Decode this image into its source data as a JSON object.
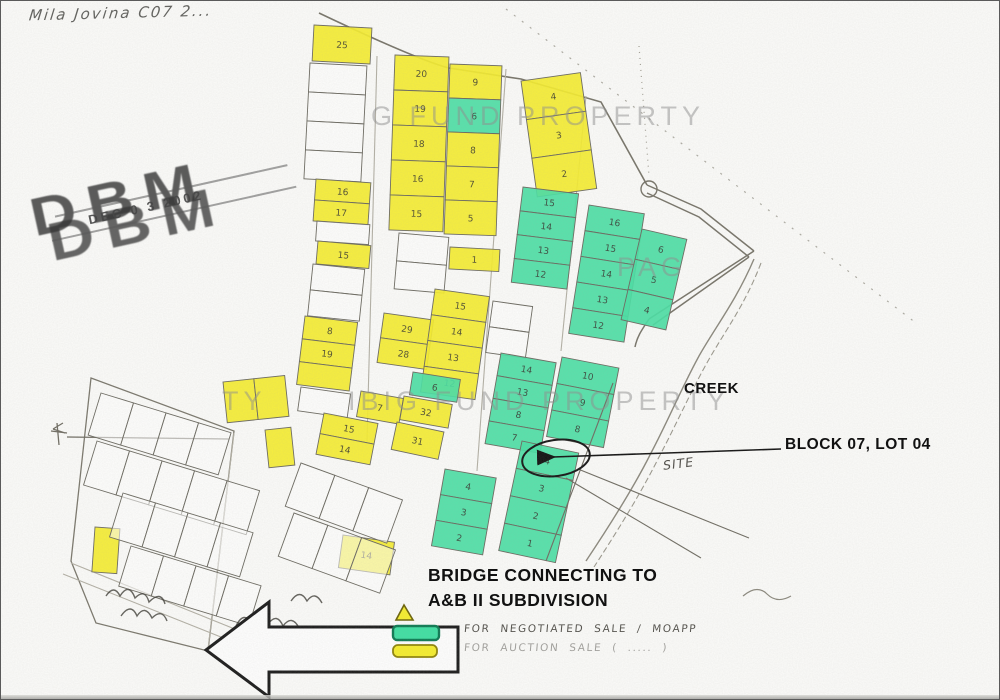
{
  "canvas": {
    "width": 1000,
    "height": 700
  },
  "colors": {
    "paper": "#fcfcfa",
    "lot_yellow": "#f6ee2d",
    "lot_yellow_border": "#8f8408",
    "lot_green": "#49e0a4",
    "lot_green_border": "#0d8a5f",
    "pencil": "#6b6960",
    "ink": "#1c1c1c",
    "watermark": "#8f8f8f"
  },
  "annotations": {
    "handwritten_title": "Mila Jovina  C07 2...",
    "creek": "CREEK",
    "block_lot": "BLOCK 07, LOT 04",
    "site": "SITE",
    "bridge_line1": "BRIDGE CONNECTING TO",
    "bridge_line2": "A&B II SUBDIVISION"
  },
  "stamp": {
    "agency": "DBM",
    "date": "DEC 0 3 2002"
  },
  "watermark_fragments": [
    {
      "text": "G FUND PROPERTY",
      "x": 370,
      "y": 100
    },
    {
      "text": "PAG",
      "x": 616,
      "y": 251
    },
    {
      "text": "TY",
      "x": 221,
      "y": 385
    },
    {
      "text": "IBIG FUND PROPERTY",
      "x": 347,
      "y": 385
    }
  ],
  "legend": {
    "items": [
      {
        "label": "FOR NEGOTIATED SALE / MOAPP",
        "color": "#3fe0a3",
        "border": "#0c7a52"
      },
      {
        "label": "FOR AUCTION SALE ( ..... )",
        "color": "#f6ee2d",
        "border": "#8f8408"
      }
    ]
  },
  "map": {
    "circled_lot": "4",
    "groups": [
      {
        "id": "lot25",
        "x": 313,
        "y": 24,
        "w": 58,
        "h": 36,
        "rot": 3,
        "cells": [
          {
            "c": "y",
            "n": "25"
          }
        ]
      },
      {
        "id": "leftcol-a",
        "x": 309,
        "y": 62,
        "w": 57,
        "h": 29,
        "rot": 3,
        "cells": [
          {
            "c": "w",
            "n": ""
          },
          {
            "c": "w",
            "n": ""
          },
          {
            "c": "w",
            "n": ""
          },
          {
            "c": "w",
            "n": ""
          }
        ]
      },
      {
        "id": "leftcol-b",
        "x": 315,
        "y": 178,
        "w": 55,
        "h": 21,
        "rot": 4,
        "cells": [
          {
            "c": "y",
            "n": "16"
          },
          {
            "c": "y",
            "n": "17"
          }
        ]
      },
      {
        "id": "leftcol-c",
        "x": 316,
        "y": 220,
        "w": 53,
        "h": 20,
        "rot": 4,
        "cells": [
          {
            "c": "w",
            "n": ""
          }
        ]
      },
      {
        "id": "leftcol-d",
        "x": 317,
        "y": 240,
        "w": 53,
        "h": 23,
        "rot": 5,
        "cells": [
          {
            "c": "y",
            "n": "15"
          }
        ]
      },
      {
        "id": "leftcol-e",
        "x": 312,
        "y": 263,
        "w": 52,
        "h": 26,
        "rot": 6,
        "cells": [
          {
            "c": "w",
            "n": ""
          },
          {
            "c": "w",
            "n": ""
          }
        ]
      },
      {
        "id": "leftcol-f",
        "x": 304,
        "y": 315,
        "w": 53,
        "h": 23,
        "rot": 7,
        "cells": [
          {
            "c": "y",
            "n": "8"
          },
          {
            "c": "y",
            "n": "19"
          },
          {
            "c": "y",
            "n": ""
          }
        ]
      },
      {
        "id": "leftcol-g",
        "x": 300,
        "y": 386,
        "w": 50,
        "h": 24,
        "rot": 8,
        "cells": [
          {
            "c": "w",
            "n": ""
          }
        ]
      },
      {
        "id": "leftcol-h",
        "x": 323,
        "y": 412,
        "w": 55,
        "h": 21,
        "rot": 11,
        "cells": [
          {
            "c": "y",
            "n": "15"
          },
          {
            "c": "y",
            "n": "14"
          }
        ]
      },
      {
        "id": "col2",
        "x": 394,
        "y": 54,
        "w": 54,
        "h": 35,
        "rot": 2,
        "cells": [
          {
            "c": "y",
            "n": "20"
          },
          {
            "c": "y",
            "n": "19"
          },
          {
            "c": "y",
            "n": "18"
          },
          {
            "c": "y",
            "n": "16"
          },
          {
            "c": "y",
            "n": "15"
          }
        ]
      },
      {
        "id": "col3",
        "x": 449,
        "y": 63,
        "w": 52,
        "h": 34,
        "rot": 2,
        "cells": [
          {
            "c": "y",
            "n": "9"
          },
          {
            "c": "g",
            "n": "6"
          },
          {
            "c": "y",
            "n": "8"
          },
          {
            "c": "y",
            "n": "7"
          },
          {
            "c": "y",
            "n": "5"
          }
        ]
      },
      {
        "id": "col4",
        "x": 520,
        "y": 80,
        "w": 60,
        "h": 39,
        "rot": -8,
        "cells": [
          {
            "c": "y",
            "n": "4"
          },
          {
            "c": "y",
            "n": "3"
          },
          {
            "c": "y",
            "n": "2"
          }
        ]
      },
      {
        "id": "uc-white",
        "x": 398,
        "y": 232,
        "w": 50,
        "h": 28,
        "rot": 5,
        "cells": [
          {
            "c": "w",
            "n": ""
          },
          {
            "c": "w",
            "n": ""
          }
        ]
      },
      {
        "id": "mid-1",
        "x": 449,
        "y": 246,
        "w": 50,
        "h": 22,
        "rot": 3,
        "cells": [
          {
            "c": "y",
            "n": "1"
          }
        ]
      },
      {
        "id": "mc-white",
        "x": 492,
        "y": 300,
        "w": 40,
        "h": 26,
        "rot": 8,
        "cells": [
          {
            "c": "w",
            "n": ""
          },
          {
            "c": "w",
            "n": ""
          }
        ]
      },
      {
        "id": "mid-29",
        "x": 383,
        "y": 312,
        "w": 50,
        "h": 25,
        "rot": 8,
        "cells": [
          {
            "c": "y",
            "n": "29"
          },
          {
            "c": "y",
            "n": "28"
          }
        ]
      },
      {
        "id": "mid-tall",
        "x": 434,
        "y": 288,
        "w": 55,
        "h": 26,
        "rot": 8,
        "cells": [
          {
            "c": "y",
            "n": "15"
          },
          {
            "c": "y",
            "n": "14"
          },
          {
            "c": "y",
            "n": "13"
          },
          {
            "c": "y",
            "n": "12"
          }
        ]
      },
      {
        "id": "mid-g6",
        "x": 412,
        "y": 371,
        "w": 48,
        "h": 23,
        "rot": 9,
        "cells": [
          {
            "c": "g",
            "n": "6"
          }
        ]
      },
      {
        "id": "mid-7",
        "x": 360,
        "y": 390,
        "w": 43,
        "h": 26,
        "rot": 10,
        "cells": [
          {
            "c": "y",
            "n": "7"
          }
        ]
      },
      {
        "id": "mid-32",
        "x": 403,
        "y": 395,
        "w": 49,
        "h": 24,
        "rot": 10,
        "cells": [
          {
            "c": "y",
            "n": "32"
          }
        ]
      },
      {
        "id": "mid-31",
        "x": 396,
        "y": 421,
        "w": 48,
        "h": 28,
        "rot": 12,
        "cells": [
          {
            "c": "y",
            "n": "31"
          }
        ]
      },
      {
        "id": "pair-top",
        "x": 222,
        "y": 381,
        "w": 31,
        "h": 41,
        "rot": -6,
        "dir": "h",
        "cells": [
          {
            "c": "y",
            "n": ""
          },
          {
            "c": "y",
            "n": ""
          }
        ]
      },
      {
        "id": "single-right",
        "x": 264,
        "y": 429,
        "w": 26,
        "h": 38,
        "rot": -6,
        "cells": [
          {
            "c": "y",
            "n": ""
          }
        ]
      },
      {
        "id": "narrow-left",
        "x": 94,
        "y": 526,
        "w": 25,
        "h": 45,
        "rot": 4,
        "cells": [
          {
            "c": "y",
            "n": ""
          }
        ]
      },
      {
        "id": "bottom-mid",
        "x": 342,
        "y": 534,
        "w": 52,
        "h": 33,
        "rot": 8,
        "cells": [
          {
            "c": "y",
            "n": "14"
          }
        ]
      },
      {
        "id": "g-col1",
        "x": 522,
        "y": 186,
        "w": 56,
        "h": 24,
        "rot": 7,
        "cells": [
          {
            "c": "g",
            "n": "15"
          },
          {
            "c": "g",
            "n": "14"
          },
          {
            "c": "g",
            "n": "13"
          },
          {
            "c": "g",
            "n": "12"
          }
        ]
      },
      {
        "id": "g-col2",
        "x": 588,
        "y": 204,
        "w": 56,
        "h": 26,
        "rot": 9,
        "cells": [
          {
            "c": "g",
            "n": "16"
          },
          {
            "c": "g",
            "n": "15"
          },
          {
            "c": "g",
            "n": "14"
          },
          {
            "c": "g",
            "n": "13"
          },
          {
            "c": "g",
            "n": "12"
          }
        ]
      },
      {
        "id": "g-col2b",
        "x": 641,
        "y": 228,
        "w": 46,
        "h": 31,
        "rot": 13,
        "cells": [
          {
            "c": "g",
            "n": "6"
          },
          {
            "c": "g",
            "n": "5"
          },
          {
            "c": "g",
            "n": "4"
          }
        ]
      },
      {
        "id": "g-col3",
        "x": 500,
        "y": 352,
        "w": 56,
        "h": 23,
        "rot": 10,
        "cells": [
          {
            "c": "g",
            "n": "14"
          },
          {
            "c": "g",
            "n": "13"
          },
          {
            "c": "g",
            "n": "8"
          },
          {
            "c": "g",
            "n": "7"
          }
        ]
      },
      {
        "id": "g-col5",
        "x": 561,
        "y": 356,
        "w": 58,
        "h": 27,
        "rot": 11,
        "cells": [
          {
            "c": "g",
            "n": "10"
          },
          {
            "c": "g",
            "n": "9"
          },
          {
            "c": "g",
            "n": "8"
          }
        ]
      },
      {
        "id": "g-col4",
        "x": 444,
        "y": 468,
        "w": 52,
        "h": 26,
        "rot": 10,
        "cells": [
          {
            "c": "g",
            "n": "4"
          },
          {
            "c": "g",
            "n": "3"
          },
          {
            "c": "g",
            "n": "2"
          }
        ]
      },
      {
        "id": "g-col6",
        "x": 521,
        "y": 440,
        "w": 58,
        "h": 28,
        "rot": 12,
        "cells": [
          {
            "c": "g",
            "n": "4"
          },
          {
            "c": "g",
            "n": "3"
          },
          {
            "c": "g",
            "n": "2"
          },
          {
            "c": "g",
            "n": "1"
          }
        ]
      },
      {
        "id": "bl-row1",
        "x": 100,
        "y": 392,
        "w": 34,
        "h": 44,
        "rot": 17,
        "dir": "h",
        "cells": [
          {
            "c": "w",
            "n": ""
          },
          {
            "c": "w",
            "n": ""
          },
          {
            "c": "w",
            "n": ""
          },
          {
            "c": "w",
            "n": ""
          }
        ]
      },
      {
        "id": "bl-row2",
        "x": 96,
        "y": 440,
        "w": 34,
        "h": 46,
        "rot": 17,
        "dir": "h",
        "cells": [
          {
            "c": "w",
            "n": ""
          },
          {
            "c": "w",
            "n": ""
          },
          {
            "c": "w",
            "n": ""
          },
          {
            "c": "w",
            "n": ""
          },
          {
            "c": "w",
            "n": ""
          }
        ]
      },
      {
        "id": "bl-row3",
        "x": 122,
        "y": 492,
        "w": 34,
        "h": 46,
        "rot": 17,
        "dir": "h",
        "cells": [
          {
            "c": "w",
            "n": ""
          },
          {
            "c": "w",
            "n": ""
          },
          {
            "c": "w",
            "n": ""
          },
          {
            "c": "w",
            "n": ""
          }
        ]
      },
      {
        "id": "bl-row4",
        "x": 130,
        "y": 545,
        "w": 34,
        "h": 42,
        "rot": 17,
        "dir": "h",
        "cells": [
          {
            "c": "w",
            "n": ""
          },
          {
            "c": "w",
            "n": ""
          },
          {
            "c": "w",
            "n": ""
          },
          {
            "c": "w",
            "n": ""
          }
        ]
      },
      {
        "id": "cb-row1",
        "x": 300,
        "y": 462,
        "w": 36,
        "h": 46,
        "rot": 20,
        "dir": "h",
        "cells": [
          {
            "c": "w",
            "n": ""
          },
          {
            "c": "w",
            "n": ""
          },
          {
            "c": "w",
            "n": ""
          }
        ]
      },
      {
        "id": "cb-row2",
        "x": 293,
        "y": 512,
        "w": 36,
        "h": 46,
        "rot": 20,
        "dir": "h",
        "cells": [
          {
            "c": "w",
            "n": ""
          },
          {
            "c": "w",
            "n": ""
          },
          {
            "c": "w",
            "n": ""
          }
        ]
      }
    ]
  }
}
